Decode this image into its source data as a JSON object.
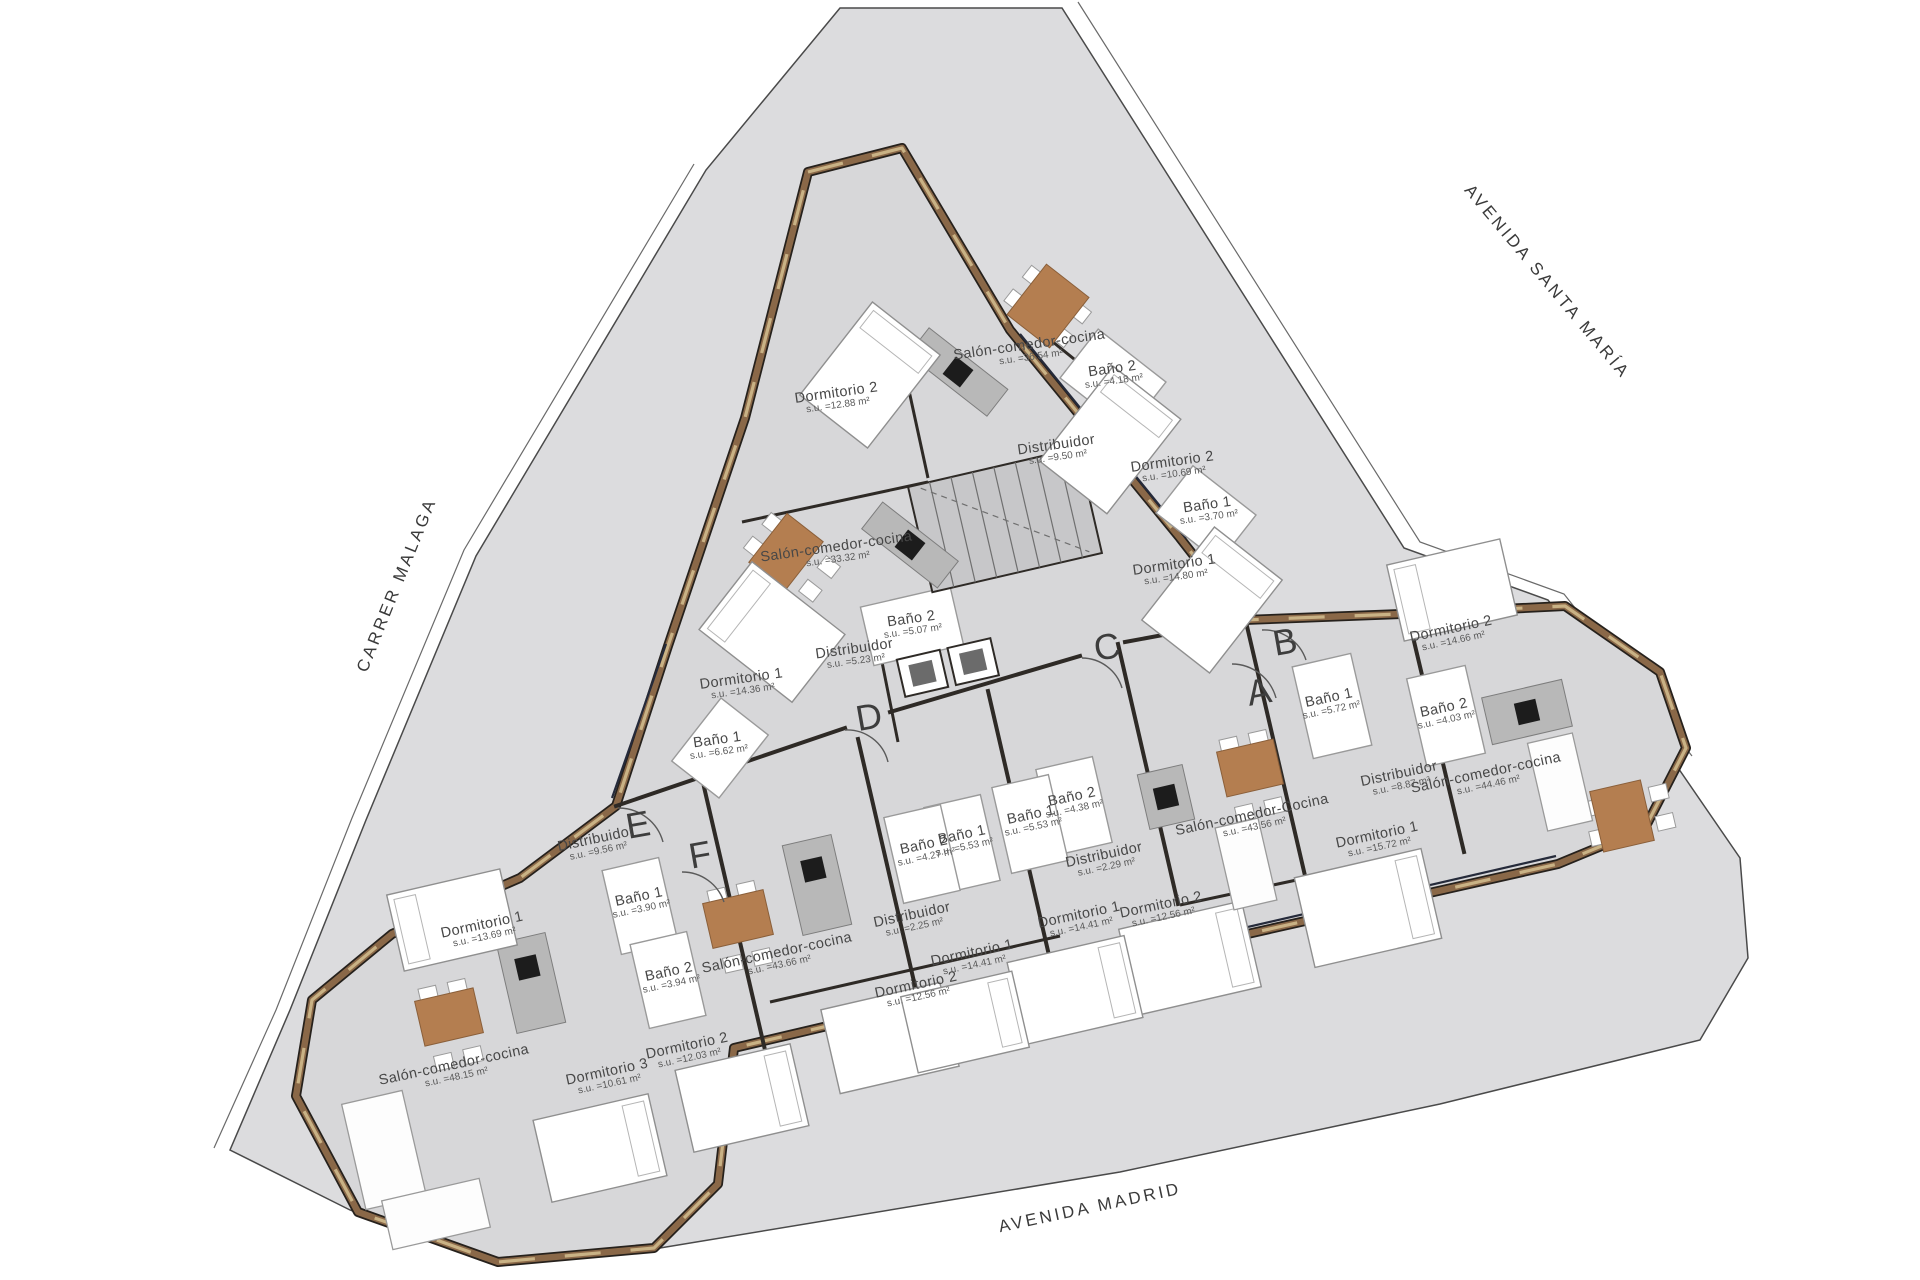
{
  "page": {
    "background": "#ffffff"
  },
  "colors": {
    "site_fill": "#dcdcde",
    "floor": "#d7d7d9",
    "wall_wood": "#8a6848",
    "wall_dark": "#26211c",
    "wood_accent": "#b47e50",
    "counter_gray": "#b8b8b8",
    "label_text": "#474747"
  },
  "streets": [
    {
      "label": "AVENIDA SANTA MARÍA",
      "x": 1547,
      "y": 282,
      "r": 50
    },
    {
      "label": "CARRER MALAGA",
      "x": 397,
      "y": 585,
      "r": -68
    },
    {
      "label": "AVENIDA MADRID",
      "x": 1090,
      "y": 1208,
      "r": -12
    }
  ],
  "unit_markers": [
    {
      "label": "A",
      "x": 1259,
      "y": 692
    },
    {
      "label": "B",
      "x": 1285,
      "y": 642
    },
    {
      "label": "C",
      "x": 1107,
      "y": 647
    },
    {
      "label": "D",
      "x": 869,
      "y": 717
    },
    {
      "label": "E",
      "x": 638,
      "y": 825
    },
    {
      "label": "F",
      "x": 700,
      "y": 855
    }
  ],
  "rooms": [
    {
      "unit": "top",
      "name": "Salón-comedor-cocina",
      "area": "s.u. =36.54 m²",
      "x": 1030,
      "y": 350,
      "r": -8
    },
    {
      "unit": "top",
      "name": "Baño 2",
      "area": "s.u. =4.18 m²",
      "x": 1113,
      "y": 374,
      "r": -8
    },
    {
      "unit": "top",
      "name": "Dormitorio 2",
      "area": "s.u. =12.88 m²",
      "x": 837,
      "y": 398,
      "r": -8
    },
    {
      "unit": "top",
      "name": "Distribuidor",
      "area": "s.u. =9.50 m²",
      "x": 1057,
      "y": 450,
      "r": -8
    },
    {
      "unit": "top",
      "name": "Dormitorio 2",
      "area": "s.u. =10.69 m²",
      "x": 1173,
      "y": 467,
      "r": -8
    },
    {
      "unit": "top",
      "name": "Baño 1",
      "area": "s.u. =3.70 m²",
      "x": 1208,
      "y": 510,
      "r": -8
    },
    {
      "unit": "top",
      "name": "Dormitorio 1",
      "area": "s.u. =14.80 m²",
      "x": 1175,
      "y": 570,
      "r": -8
    },
    {
      "unit": "mid-left",
      "name": "Salón-comedor-cocina",
      "area": "s.u. =33.32 m²",
      "x": 837,
      "y": 552,
      "r": -8
    },
    {
      "unit": "mid-left",
      "name": "Baño 2",
      "area": "s.u. =5.07 m²",
      "x": 912,
      "y": 624,
      "r": -8
    },
    {
      "unit": "mid-left",
      "name": "Distribuidor",
      "area": "s.u. =5.23 m²",
      "x": 855,
      "y": 654,
      "r": -8
    },
    {
      "unit": "mid-left",
      "name": "Dormitorio 1",
      "area": "s.u. =14.36 m²",
      "x": 742,
      "y": 684,
      "r": -8
    },
    {
      "unit": "mid-left",
      "name": "Baño 1",
      "area": "s.u. =6.62 m²",
      "x": 718,
      "y": 745,
      "r": -8
    },
    {
      "unit": "B",
      "name": "Dormitorio 2",
      "area": "s.u. =14.66 m²",
      "x": 1452,
      "y": 634,
      "r": -12
    },
    {
      "unit": "B",
      "name": "Baño 1",
      "area": "s.u. =5.72 m²",
      "x": 1330,
      "y": 703,
      "r": -12
    },
    {
      "unit": "B",
      "name": "Baño 2",
      "area": "s.u. =4.03 m²",
      "x": 1445,
      "y": 713,
      "r": -12
    },
    {
      "unit": "B",
      "name": "Distribuidor",
      "area": "s.u. =8.87 m²",
      "x": 1400,
      "y": 779,
      "r": -12
    },
    {
      "unit": "B",
      "name": "Salón-comedor-cocina",
      "area": "s.u. =44.46 m²",
      "x": 1487,
      "y": 778,
      "r": -12
    },
    {
      "unit": "B",
      "name": "Dormitorio 1",
      "area": "s.u. =15.72 m²",
      "x": 1378,
      "y": 840,
      "r": -12
    },
    {
      "unit": "A",
      "name": "Salón-comedor-Cocina",
      "area": "s.u. =43.56 m²",
      "x": 1253,
      "y": 820,
      "r": -12
    },
    {
      "unit": "A",
      "name": "Baño 2",
      "area": "s.u. =4.38 m²",
      "x": 1073,
      "y": 802,
      "r": -12
    },
    {
      "unit": "A",
      "name": "Baño 1",
      "area": "s.u. =5.53 m²",
      "x": 1032,
      "y": 820,
      "r": -12
    },
    {
      "unit": "A",
      "name": "Distribuidor",
      "area": "s.u. =2.29 m²",
      "x": 1105,
      "y": 860,
      "r": -12
    },
    {
      "unit": "A",
      "name": "Dormitorio 1",
      "area": "s.u. =14.41 m²",
      "x": 1080,
      "y": 920,
      "r": -12
    },
    {
      "unit": "A",
      "name": "Dormitorio 2",
      "area": "s.u. =12.56 m²",
      "x": 1162,
      "y": 910,
      "r": -12
    },
    {
      "unit": "F",
      "name": "Baño 1",
      "area": "s.u. =5.53 m²",
      "x": 963,
      "y": 840,
      "r": -12
    },
    {
      "unit": "F",
      "name": "Baño 2",
      "area": "s.u. =4.27 m²",
      "x": 925,
      "y": 850,
      "r": -12
    },
    {
      "unit": "F",
      "name": "Distribuidor",
      "area": "s.u. =2.25 m²",
      "x": 913,
      "y": 920,
      "r": -12
    },
    {
      "unit": "F",
      "name": "Salón-comedor-cocina",
      "area": "s.u. =43.66 m²",
      "x": 778,
      "y": 958,
      "r": -12
    },
    {
      "unit": "F",
      "name": "Dormitorio 1",
      "area": "s.u. =14.41 m²",
      "x": 973,
      "y": 958,
      "r": -12
    },
    {
      "unit": "F",
      "name": "Dormitorio 2",
      "area": "s.u. =12.56 m²",
      "x": 917,
      "y": 990,
      "r": -12
    },
    {
      "unit": "E",
      "name": "Distribuidor",
      "area": "s.u. =9.56 m²",
      "x": 597,
      "y": 844,
      "r": -12
    },
    {
      "unit": "E",
      "name": "Baño 1",
      "area": "s.u. =3.90 m²",
      "x": 640,
      "y": 902,
      "r": -12
    },
    {
      "unit": "E",
      "name": "Dormitorio 1",
      "area": "s.u. =13.69 m²",
      "x": 483,
      "y": 930,
      "r": -12
    },
    {
      "unit": "E",
      "name": "Baño 2",
      "area": "s.u. =3.94 m²",
      "x": 670,
      "y": 977,
      "r": -12
    },
    {
      "unit": "E",
      "name": "Salón-comedor-cocina",
      "area": "s.u. =48.15 m²",
      "x": 455,
      "y": 1070,
      "r": -12
    },
    {
      "unit": "E",
      "name": "Dormitorio 3",
      "area": "s.u. =10.61 m²",
      "x": 608,
      "y": 1077,
      "r": -12
    },
    {
      "unit": "E",
      "name": "Dormitorio 2",
      "area": "s.u. =12.03 m²",
      "x": 688,
      "y": 1051,
      "r": -12
    }
  ]
}
